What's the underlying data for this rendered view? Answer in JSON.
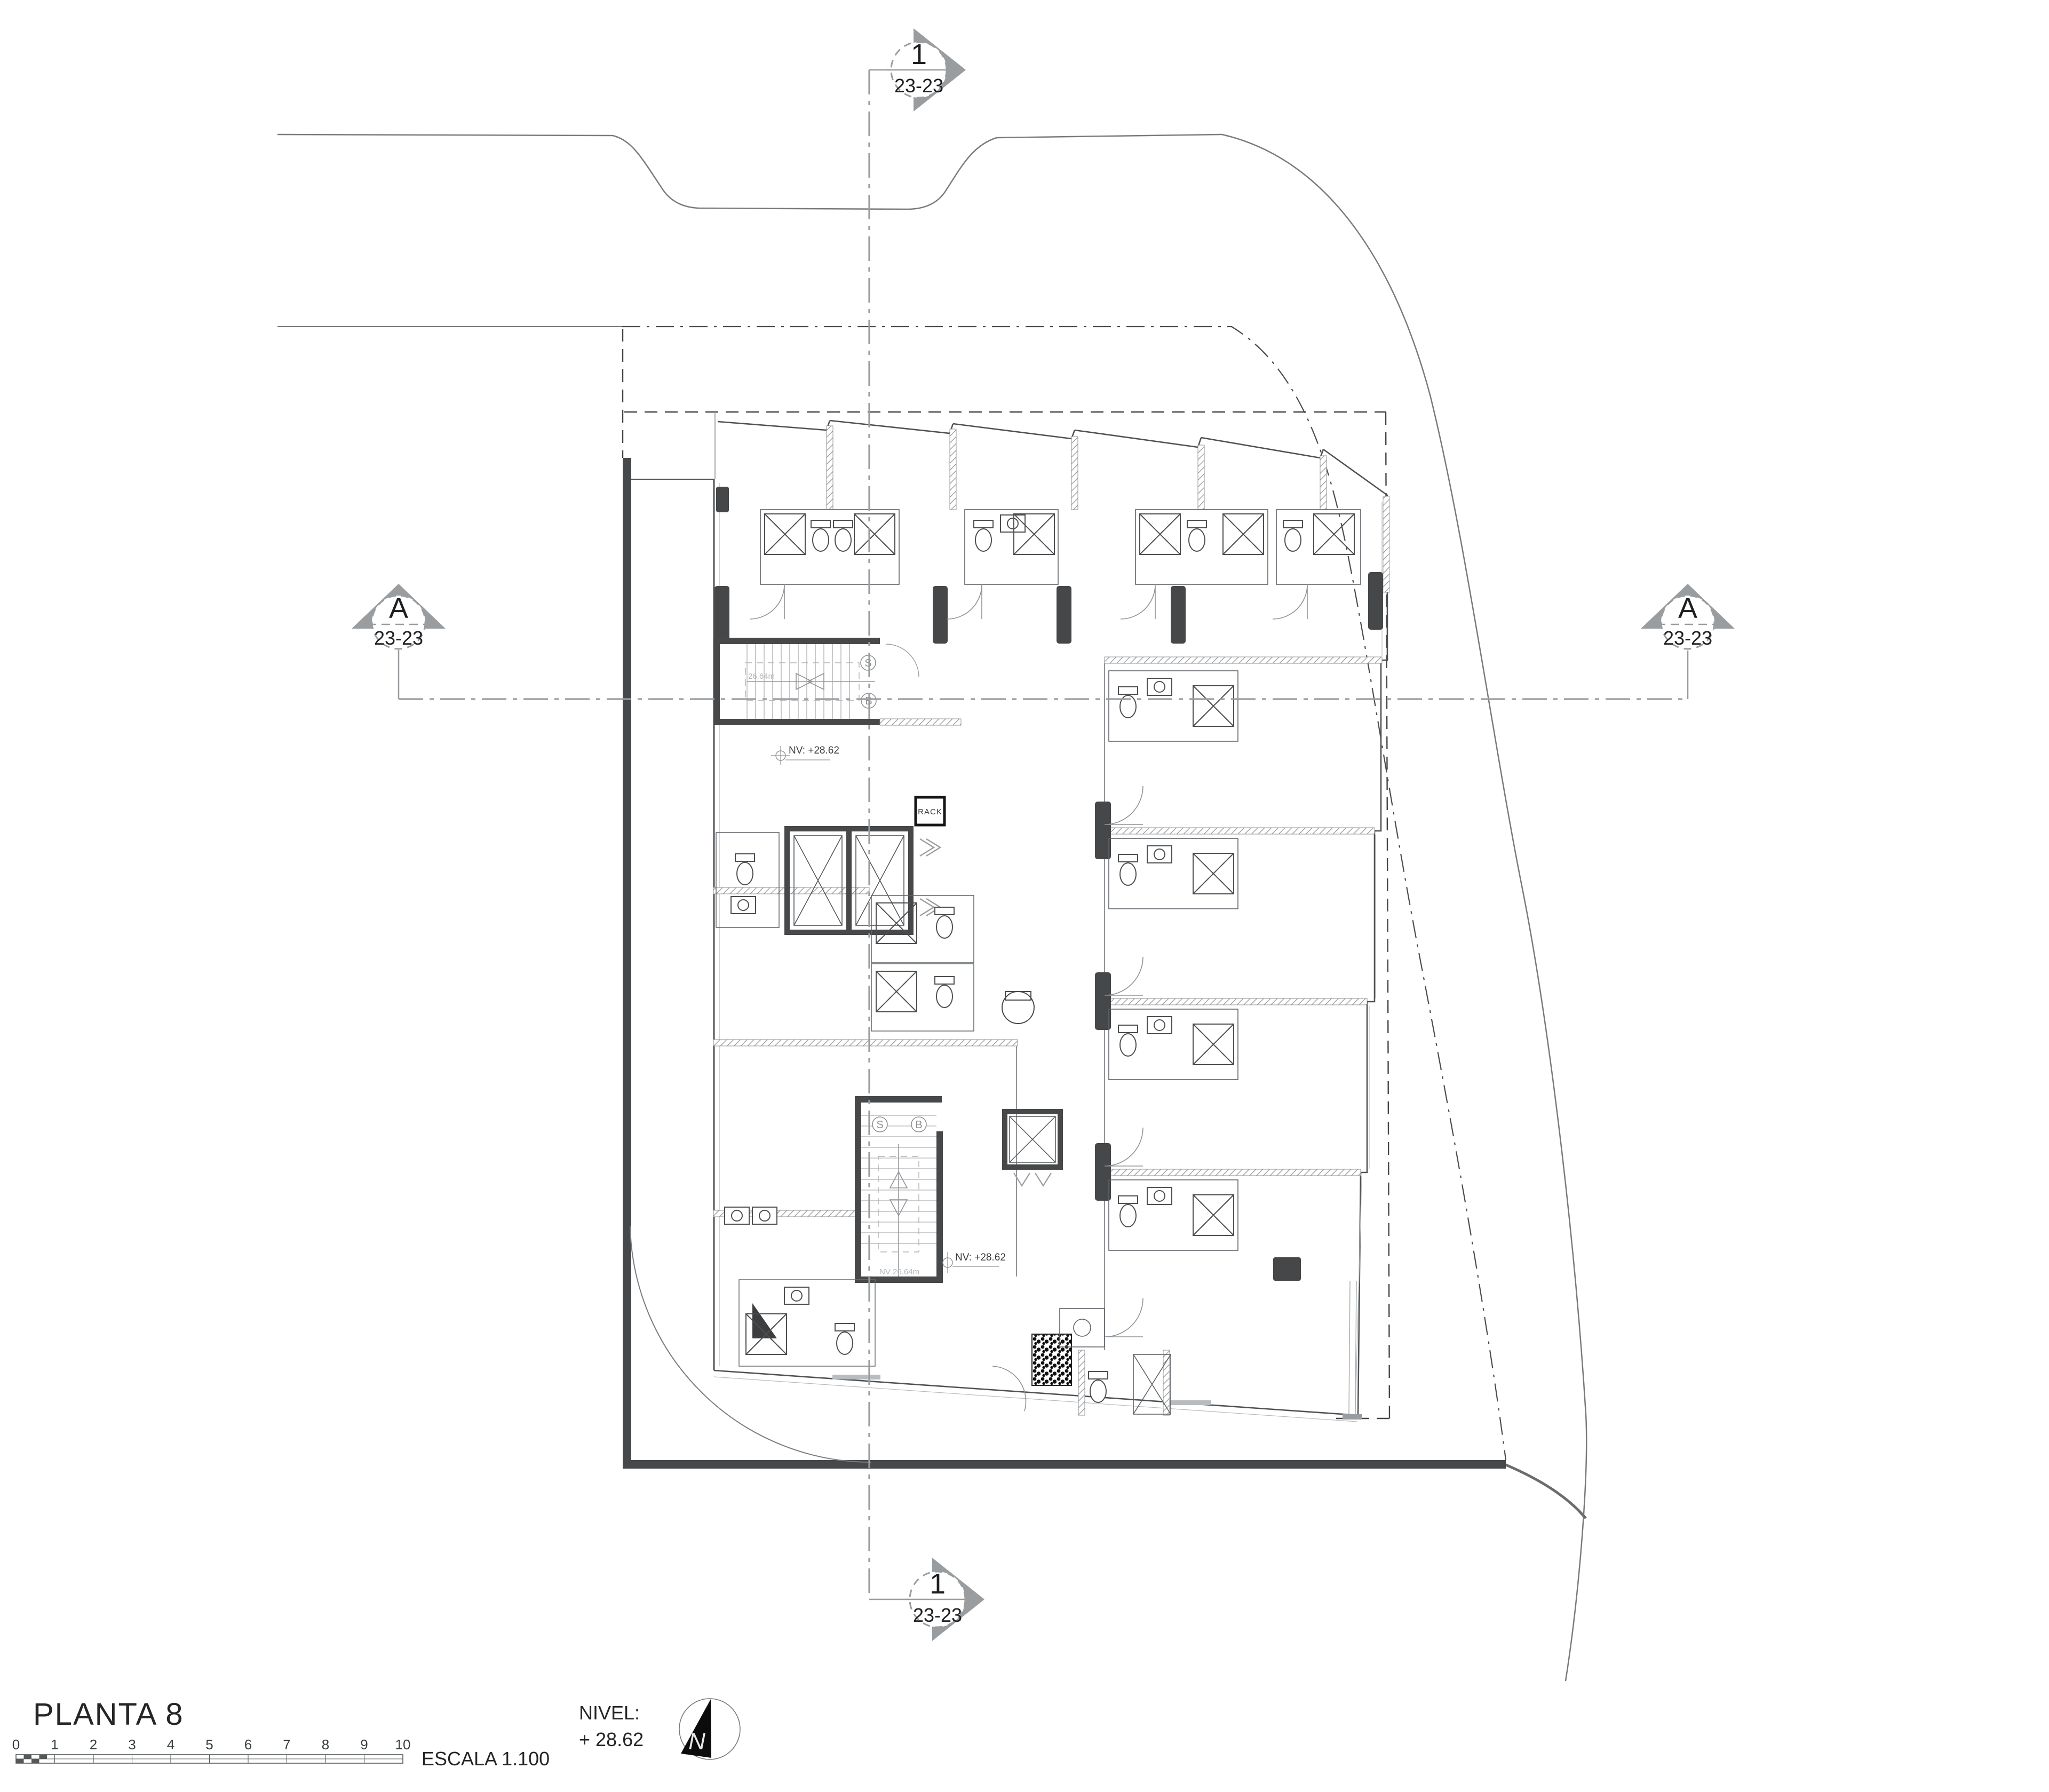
{
  "sheet": {
    "title": "PLANTA 8",
    "scale_label": "ESCALA  1.100",
    "scale_ticks": [
      "0",
      "1",
      "2",
      "3",
      "4",
      "5",
      "6",
      "7",
      "8",
      "9",
      "10"
    ],
    "level_label": "NIVEL:",
    "level_value": "+ 28.62",
    "north_letter": "N"
  },
  "section_markers": {
    "top": {
      "id": "1",
      "sheet_ref": "23-23"
    },
    "bottom": {
      "id": "1",
      "sheet_ref": "23-23"
    },
    "left": {
      "id": "A",
      "sheet_ref": "23-23"
    },
    "right": {
      "id": "A",
      "sheet_ref": "23-23"
    }
  },
  "plan_annotations": {
    "upper_level_note": "NV: +28.62",
    "lower_level_note": "NV: +28.62",
    "upper_stair_area": "26.64m",
    "lower_stair_area": "NV 26.64m",
    "rack_room": "RACK",
    "stair_up_letter": "S",
    "stair_down_letter": "B"
  },
  "palette": {
    "paper": "#ffffff",
    "wall_dark": "#46484a",
    "line_mid": "#5f6368",
    "line_light": "#a9adb2",
    "marker_gray": "#9a9d9f",
    "north_fill": "#0c0c0c"
  }
}
